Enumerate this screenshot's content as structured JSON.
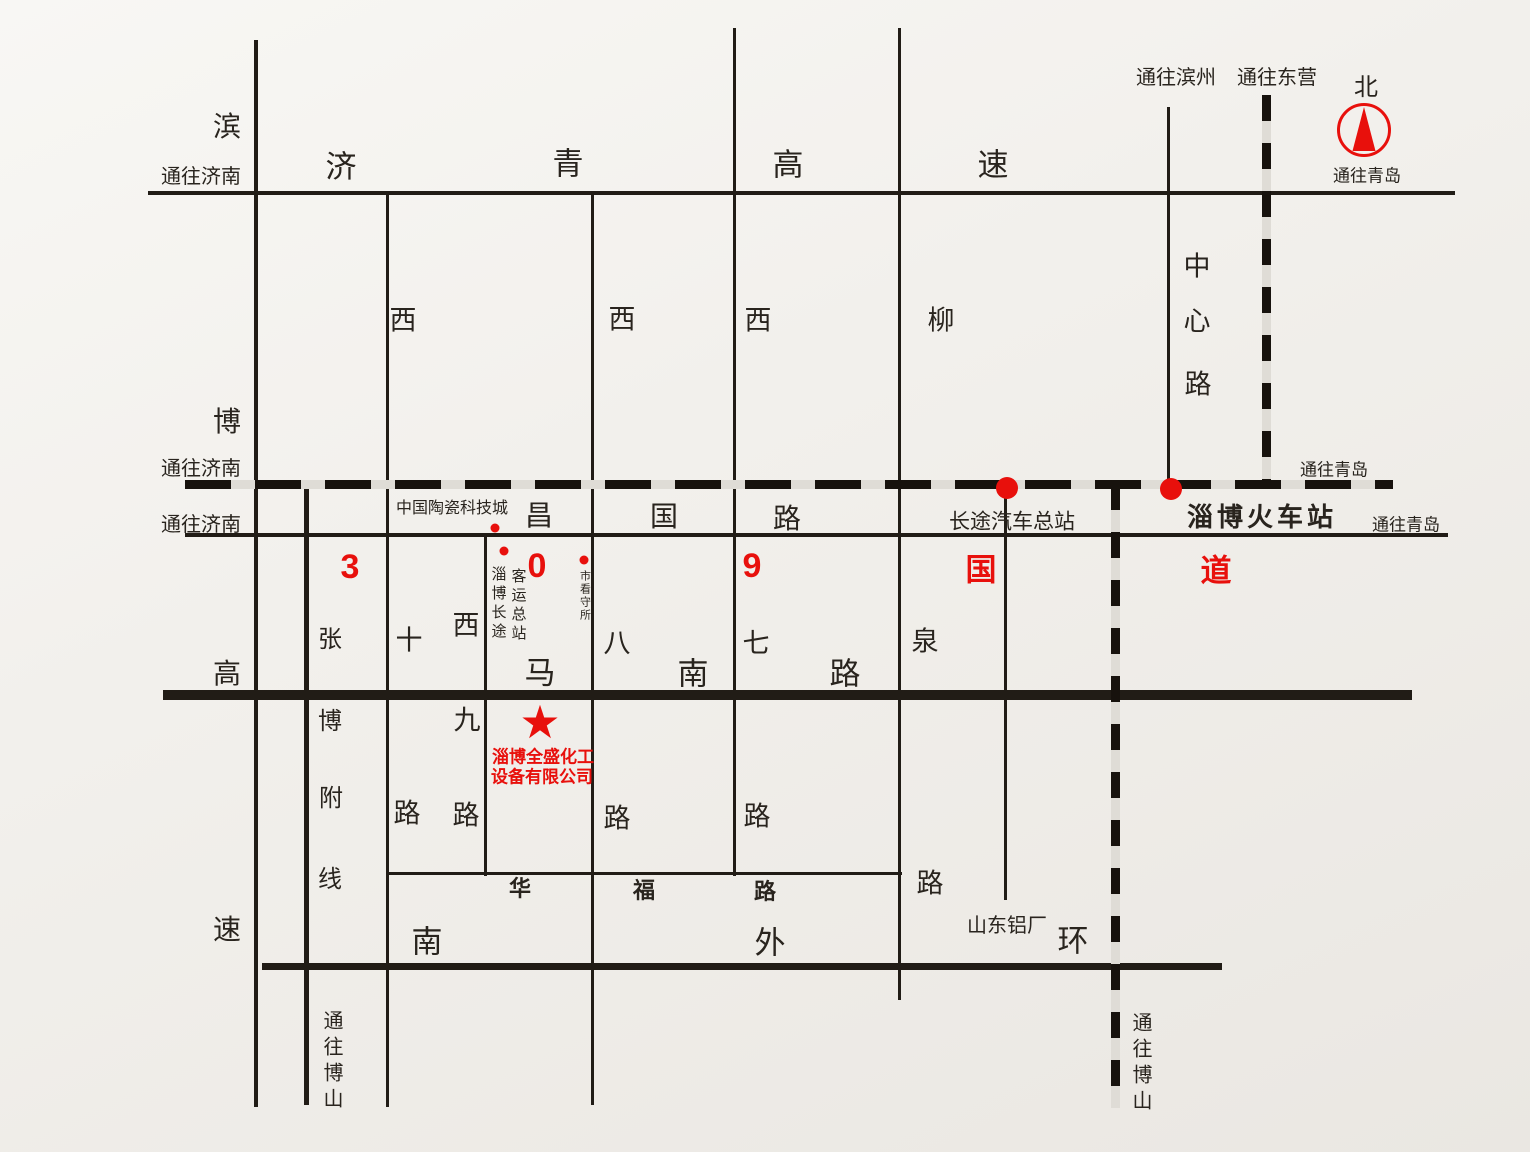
{
  "map": {
    "colors": {
      "paper": "#f1efeb",
      "ink": "#29241e",
      "road": "#211c16",
      "red": "#e8100c"
    },
    "star": {
      "symbol": "★",
      "x": 540,
      "y": 722,
      "size": 46
    },
    "roads": [
      {
        "name": "jiqing-expressway",
        "x": 148,
        "y": 191,
        "w": 1307,
        "h": 4,
        "kind": "road"
      },
      {
        "name": "binbo-expressway",
        "x": 254,
        "y": 40,
        "w": 4,
        "h": 1067,
        "kind": "road"
      },
      {
        "name": "changguo-road",
        "x": 185,
        "y": 533,
        "w": 1263,
        "h": 4,
        "kind": "road"
      },
      {
        "name": "manan-road",
        "x": 163,
        "y": 690,
        "w": 1249,
        "h": 10,
        "kind": "road"
      },
      {
        "name": "huafu-road",
        "x": 388,
        "y": 872,
        "w": 514,
        "h": 3,
        "kind": "road"
      },
      {
        "name": "nanwaihuan-road",
        "x": 262,
        "y": 963,
        "w": 960,
        "h": 7,
        "kind": "road"
      },
      {
        "name": "zhangbo-branch-line",
        "x": 304,
        "y": 486,
        "w": 5,
        "h": 619,
        "kind": "road"
      },
      {
        "name": "xishi-road",
        "x": 386,
        "y": 193,
        "w": 3,
        "h": 914,
        "kind": "road"
      },
      {
        "name": "xijiu-road",
        "x": 484,
        "y": 535,
        "w": 3,
        "h": 341,
        "kind": "road"
      },
      {
        "name": "xiba-road",
        "x": 591,
        "y": 193,
        "w": 3,
        "h": 912,
        "kind": "road"
      },
      {
        "name": "xiqi-road",
        "x": 733,
        "y": 28,
        "w": 3,
        "h": 848,
        "kind": "road"
      },
      {
        "name": "liuquan-road",
        "x": 898,
        "y": 28,
        "w": 3,
        "h": 972,
        "kind": "road"
      },
      {
        "name": "bus-terminal-road",
        "x": 1004,
        "y": 488,
        "w": 3,
        "h": 412,
        "kind": "road"
      },
      {
        "name": "zhongxin-road",
        "x": 1167,
        "y": 107,
        "w": 3,
        "h": 383,
        "kind": "road"
      },
      {
        "name": "railway-jiqing-main",
        "x": 185,
        "y": 480,
        "w": 1208,
        "h": 9,
        "kind": "railway-h"
      },
      {
        "name": "railway-to-dongying",
        "x": 1262,
        "y": 95,
        "w": 9,
        "h": 393,
        "kind": "railway-v"
      },
      {
        "name": "railway-to-boshan",
        "x": 1111,
        "y": 484,
        "w": 9,
        "h": 624,
        "kind": "railway-v"
      }
    ],
    "dots": [
      {
        "name": "ceramics-city-dot",
        "x": 495,
        "y": 528,
        "d": 9
      },
      {
        "name": "coach-station-dot",
        "x": 504,
        "y": 551,
        "d": 9
      },
      {
        "name": "detention-center-dot",
        "x": 584,
        "y": 560,
        "d": 9
      },
      {
        "name": "bus-terminal-dot",
        "x": 1007,
        "y": 488,
        "d": 22
      },
      {
        "name": "railway-station-dot",
        "x": 1171,
        "y": 489,
        "d": 22
      }
    ],
    "labels": [
      {
        "name": "binbo-expwy-char-bin",
        "text": "滨",
        "x": 227,
        "y": 127,
        "size": 28
      },
      {
        "name": "to-jinan-top",
        "text": "通往济南",
        "x": 201,
        "y": 177,
        "size": 20
      },
      {
        "name": "jiqing-expwy-char-ji",
        "text": "济",
        "x": 341,
        "y": 167,
        "size": 31
      },
      {
        "name": "jiqing-expwy-char-qing",
        "text": "青",
        "x": 568,
        "y": 164,
        "size": 31
      },
      {
        "name": "jiqing-expwy-char-gao",
        "text": "高",
        "x": 788,
        "y": 165,
        "size": 31
      },
      {
        "name": "jiqing-expwy-char-su",
        "text": "速",
        "x": 993,
        "y": 165,
        "size": 31
      },
      {
        "name": "to-binzhou",
        "text": "通往滨州",
        "x": 1176,
        "y": 78,
        "size": 20
      },
      {
        "name": "to-dongying",
        "text": "通往东营",
        "x": 1277,
        "y": 78,
        "size": 20
      },
      {
        "name": "north-char",
        "text": "北",
        "x": 1366,
        "y": 88,
        "size": 24
      },
      {
        "name": "to-qingdao-compass",
        "text": "通往青岛",
        "x": 1367,
        "y": 176,
        "size": 17
      },
      {
        "name": "xishi-char-xi",
        "text": "西",
        "x": 403,
        "y": 321,
        "size": 27
      },
      {
        "name": "xiba-char-xi",
        "text": "西",
        "x": 622,
        "y": 320,
        "size": 27
      },
      {
        "name": "xiqi-char-xi",
        "text": "西",
        "x": 758,
        "y": 321,
        "size": 27
      },
      {
        "name": "liuquan-char-liu",
        "text": "柳",
        "x": 941,
        "y": 321,
        "size": 27
      },
      {
        "name": "zhongxin-char-zhong",
        "text": "中",
        "x": 1197,
        "y": 267,
        "size": 27
      },
      {
        "name": "zhongxin-char-xin",
        "text": "心",
        "x": 1197,
        "y": 322,
        "size": 27
      },
      {
        "name": "zhongxin-char-lu",
        "text": "路",
        "x": 1198,
        "y": 385,
        "size": 27
      },
      {
        "name": "binbo-expwy-char-bo",
        "text": "博",
        "x": 227,
        "y": 422,
        "size": 28
      },
      {
        "name": "to-jinan-railway",
        "text": "通往济南",
        "x": 201,
        "y": 469,
        "size": 20
      },
      {
        "name": "to-jinan-changguo",
        "text": "通往济南",
        "x": 201,
        "y": 525,
        "size": 20
      },
      {
        "name": "ceramics-city",
        "text": "中国陶瓷科技城",
        "x": 452,
        "y": 509,
        "size": 16
      },
      {
        "name": "changguo-char-chang",
        "text": "昌",
        "x": 539,
        "y": 516,
        "size": 28
      },
      {
        "name": "changguo-char-guo",
        "text": "国",
        "x": 664,
        "y": 517,
        "size": 28
      },
      {
        "name": "changguo-char-lu",
        "text": "路",
        "x": 787,
        "y": 519,
        "size": 28
      },
      {
        "name": "coach-station-col-1",
        "text": "淄博长途",
        "x": 498,
        "y": 604,
        "size": 15,
        "vertical": true,
        "ls": 4
      },
      {
        "name": "coach-station-col-2",
        "text": "客运总站",
        "x": 518,
        "y": 606,
        "size": 15,
        "vertical": true,
        "ls": 4
      },
      {
        "name": "detention-center",
        "text": "市看守所",
        "x": 584,
        "y": 596,
        "size": 11,
        "vertical": true,
        "ls": 2
      },
      {
        "name": "bus-terminal",
        "text": "长途汽车总站",
        "x": 1012,
        "y": 522,
        "size": 21
      },
      {
        "name": "railway-station",
        "text": "淄博火车站",
        "x": 1262,
        "y": 517,
        "size": 26,
        "bold": true,
        "ls": 4
      },
      {
        "name": "to-qingdao-railway",
        "text": "通往青岛",
        "x": 1334,
        "y": 470,
        "size": 17
      },
      {
        "name": "to-qingdao-changguo",
        "text": "通往青岛",
        "x": 1406,
        "y": 525,
        "size": 17
      },
      {
        "name": "g309-char-3",
        "text": "3",
        "x": 350,
        "y": 567,
        "size": 34,
        "red": true,
        "bold": true
      },
      {
        "name": "g309-char-0",
        "text": "0",
        "x": 537,
        "y": 566,
        "size": 34,
        "red": true,
        "bold": true
      },
      {
        "name": "g309-char-9",
        "text": "9",
        "x": 752,
        "y": 566,
        "size": 34,
        "red": true,
        "bold": true
      },
      {
        "name": "g309-char-guo",
        "text": "国",
        "x": 981,
        "y": 570,
        "size": 31,
        "red": true,
        "bold": true
      },
      {
        "name": "g309-char-dao",
        "text": "道",
        "x": 1216,
        "y": 571,
        "size": 31,
        "red": true,
        "bold": true
      },
      {
        "name": "zhangbo-char-zhang",
        "text": "张",
        "x": 330,
        "y": 640,
        "size": 24
      },
      {
        "name": "zhangbo-char-bo",
        "text": "博",
        "x": 330,
        "y": 722,
        "size": 24
      },
      {
        "name": "zhangbo-char-fu",
        "text": "附",
        "x": 331,
        "y": 799,
        "size": 24
      },
      {
        "name": "zhangbo-char-xian",
        "text": "线",
        "x": 330,
        "y": 880,
        "size": 24
      },
      {
        "name": "binbo-expwy-char-gao",
        "text": "高",
        "x": 227,
        "y": 674,
        "size": 28
      },
      {
        "name": "binbo-expwy-char-su",
        "text": "速",
        "x": 227,
        "y": 930,
        "size": 28
      },
      {
        "name": "xishi-char-shi",
        "text": "十",
        "x": 409,
        "y": 641,
        "size": 27
      },
      {
        "name": "xishi-char-lu",
        "text": "路",
        "x": 407,
        "y": 814,
        "size": 27
      },
      {
        "name": "xijiu-char-xi",
        "text": "西",
        "x": 466,
        "y": 626,
        "size": 27
      },
      {
        "name": "xijiu-char-jiu",
        "text": "九",
        "x": 467,
        "y": 721,
        "size": 27
      },
      {
        "name": "xijiu-char-lu",
        "text": "路",
        "x": 466,
        "y": 816,
        "size": 27
      },
      {
        "name": "manan-char-ma",
        "text": "马",
        "x": 540,
        "y": 673,
        "size": 31
      },
      {
        "name": "manan-char-nan",
        "text": "南",
        "x": 693,
        "y": 674,
        "size": 31
      },
      {
        "name": "manan-char-lu",
        "text": "路",
        "x": 845,
        "y": 674,
        "size": 31
      },
      {
        "name": "xiba-char-ba",
        "text": "八",
        "x": 617,
        "y": 644,
        "size": 27
      },
      {
        "name": "xiba-char-lu",
        "text": "路",
        "x": 617,
        "y": 819,
        "size": 27
      },
      {
        "name": "xiqi-char-qi",
        "text": "七",
        "x": 756,
        "y": 644,
        "size": 27
      },
      {
        "name": "xiqi-char-lu",
        "text": "路",
        "x": 757,
        "y": 817,
        "size": 27
      },
      {
        "name": "liuquan-char-quan",
        "text": "泉",
        "x": 925,
        "y": 642,
        "size": 27
      },
      {
        "name": "liuquan-char-lu",
        "text": "路",
        "x": 930,
        "y": 884,
        "size": 27
      },
      {
        "name": "company-name-line1",
        "text": "淄博全盛化工",
        "x": 543,
        "y": 757,
        "size": 17,
        "red": true,
        "bold": true
      },
      {
        "name": "company-name-line2",
        "text": "设备有限公司",
        "x": 542,
        "y": 777,
        "size": 17,
        "red": true,
        "bold": true
      },
      {
        "name": "huafu-char-hua",
        "text": "华",
        "x": 520,
        "y": 889,
        "size": 22,
        "bold": true
      },
      {
        "name": "huafu-char-fu",
        "text": "福",
        "x": 644,
        "y": 891,
        "size": 22,
        "bold": true
      },
      {
        "name": "huafu-char-lu",
        "text": "路",
        "x": 765,
        "y": 892,
        "size": 22,
        "bold": true
      },
      {
        "name": "nanwaihuan-char-nan",
        "text": "南",
        "x": 427,
        "y": 942,
        "size": 31
      },
      {
        "name": "nanwaihuan-char-wai",
        "text": "外",
        "x": 770,
        "y": 943,
        "size": 31
      },
      {
        "name": "nanwaihuan-char-huan",
        "text": "环",
        "x": 1073,
        "y": 941,
        "size": 31
      },
      {
        "name": "shandong-aluminum",
        "text": "山东铝厂",
        "x": 1007,
        "y": 926,
        "size": 20
      },
      {
        "name": "to-boshan-left",
        "text": "通往博山",
        "x": 331,
        "y": 1062,
        "size": 20,
        "vertical": true,
        "ls": 6
      },
      {
        "name": "to-boshan-right",
        "text": "通往博山",
        "x": 1140,
        "y": 1064,
        "size": 20,
        "vertical": true,
        "ls": 6
      }
    ]
  }
}
